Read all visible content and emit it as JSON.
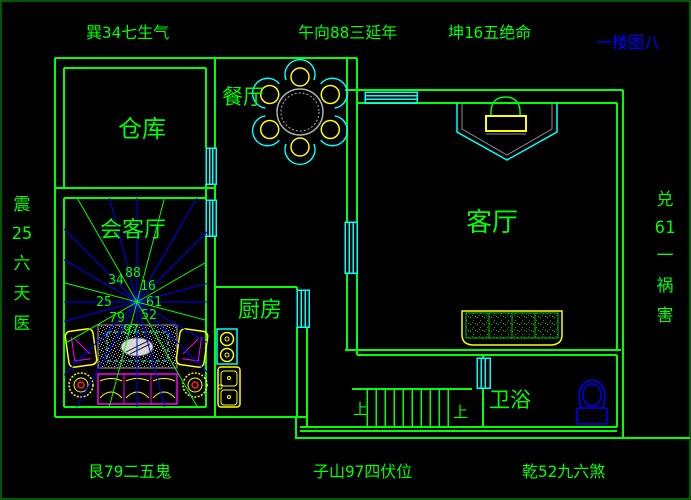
{
  "canvas": {
    "background": "#000000",
    "border_color": "#00b400"
  },
  "title": {
    "floor_label": "一楼图八",
    "color": "#0000ff"
  },
  "perimeter": {
    "top_left": "巽34七生气",
    "top_center": "午向88三延年",
    "top_right": "坤16五绝命",
    "bottom_left": "艮79二五鬼",
    "bottom_center": "子山97四伏位",
    "bottom_right": "乾52九六煞",
    "left_vertical": [
      "震",
      "25",
      "六",
      "天",
      "医"
    ],
    "right_vertical": [
      "兑",
      "61",
      "一",
      "祸",
      "害"
    ],
    "color": "#00ff00"
  },
  "rooms": {
    "storeroom": "仓库",
    "dining": "餐厅",
    "reception": "会客厅",
    "kitchen": "厨房",
    "living": "客厅",
    "bath": "卫浴"
  },
  "compass": {
    "numbers": [
      "34",
      "88",
      "16",
      "25",
      "61",
      "79",
      "97",
      "52"
    ],
    "ray_color_primary": "#0000ff",
    "ray_color_secondary": "#00ff00"
  },
  "stairs": {
    "up": "上"
  },
  "palette": {
    "wall": "#00ff00",
    "window": "#00ffff",
    "furniture_yellow": "#ffff00",
    "furniture_magenta": "#ff00ff",
    "fixture_blue": "#0000ff",
    "table_gray": "#b0b0b0"
  }
}
